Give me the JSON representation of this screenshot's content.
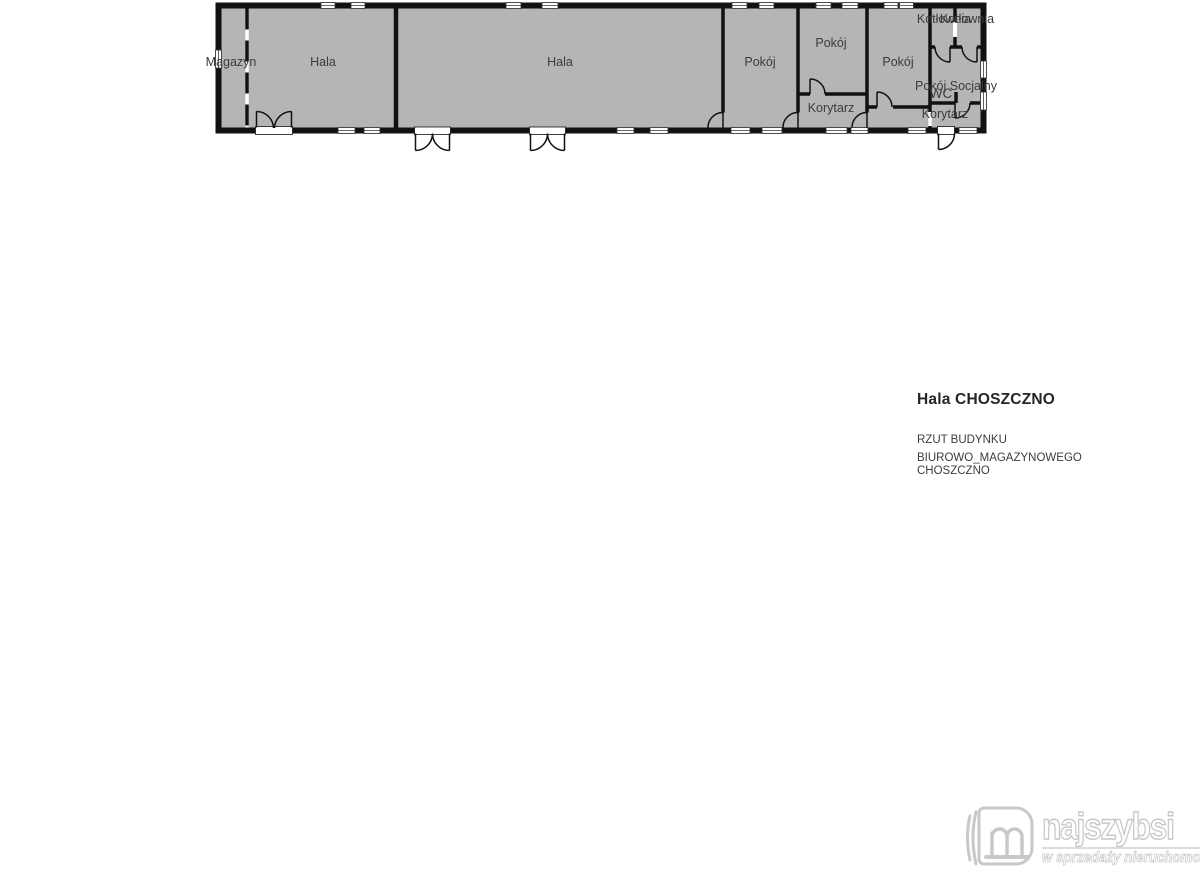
{
  "floor_plan": {
    "rooms": [
      {
        "label": "Magazyn"
      },
      {
        "label": "Hala"
      },
      {
        "label": "Hala"
      },
      {
        "label": "Pokój"
      },
      {
        "label": "Pokój"
      },
      {
        "label": "Korytarz"
      },
      {
        "label": "Pokój"
      },
      {
        "label": "Kotłownia"
      },
      {
        "label": "Kotłownia"
      },
      {
        "label": "Pokój Socjalny"
      },
      {
        "label": "WC"
      },
      {
        "label": "Korytarz"
      }
    ],
    "colors": {
      "room_fill": "#b5b5b5",
      "wall": "#111111",
      "label": "#3b3b3b"
    }
  },
  "title_block": {
    "title": "Hala CHOSZCZNO",
    "subtitle_line1": "RZUT BUDYNKU",
    "subtitle_line2": "BIUROWO_MAGAZYNOWEGO",
    "subtitle_line3": "CHOSZCZNO"
  },
  "watermark": {
    "brand": "najszybsi",
    "tagline": "w sprzedaży nieruchomości",
    "color": "#c8c8c8"
  }
}
